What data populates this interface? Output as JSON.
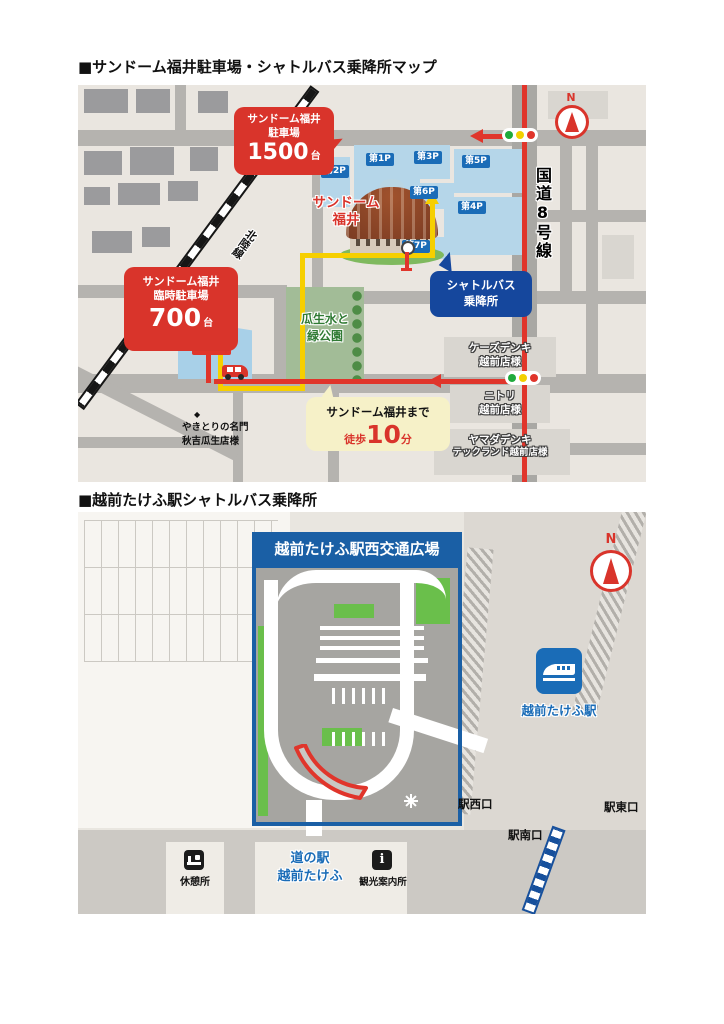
{
  "map1": {
    "title": "■サンドーム福井駐車場・シャトルバス乗降所マップ",
    "north": "N",
    "main_parking": {
      "line1": "サンドーム福井",
      "line2": "駐車場",
      "number": "1500",
      "unit": "台"
    },
    "temp_parking": {
      "line1": "サンドーム福井",
      "line2": "臨時駐車場",
      "number": "700",
      "unit": "台"
    },
    "temp_parking_badge": "臨時P",
    "dome": {
      "line1": "サンドーム",
      "line2": "福井"
    },
    "shuttle_stop": {
      "line1": "シャトルバス",
      "line2": "乗降所"
    },
    "park": {
      "line1": "瓜生水と",
      "line2": "緑公園"
    },
    "walk": {
      "line1": "サンドーム福井まで",
      "walk_label": "徒歩",
      "minutes": "10",
      "unit": "分"
    },
    "route8": "国道8号線",
    "railway": "北陸線",
    "lots": {
      "p1": "第1P",
      "p2": "第2P",
      "p3": "第3P",
      "p4": "第4P",
      "p5": "第5P",
      "p6": "第6P",
      "p7": "第7P"
    },
    "stores": {
      "ks": {
        "line1": "ケーズデンキ",
        "line2": "越前店様"
      },
      "nitori": {
        "line1": "ニトリ",
        "line2": "越前店様"
      },
      "yamada": {
        "line1": "ヤマダデンキ",
        "line2": "テックランド越前店様"
      }
    },
    "yakitori": {
      "marker": "◆",
      "line1": "やきとりの名門",
      "line2": "秋吉瓜生店様"
    }
  },
  "map2": {
    "title": "■越前たけふ駅シャトルバス乗降所",
    "north": "N",
    "plaza_header": "越前たけふ駅西交通広場",
    "station": "越前たけふ駅",
    "exits": {
      "west": "駅西口",
      "east": "駅東口",
      "south": "駅南口"
    },
    "rest_area": "休憩所",
    "michinoeki": {
      "line1": "道の駅",
      "line2": "越前たけふ"
    },
    "info": {
      "glyph": "i",
      "label": "観光案内所"
    }
  }
}
